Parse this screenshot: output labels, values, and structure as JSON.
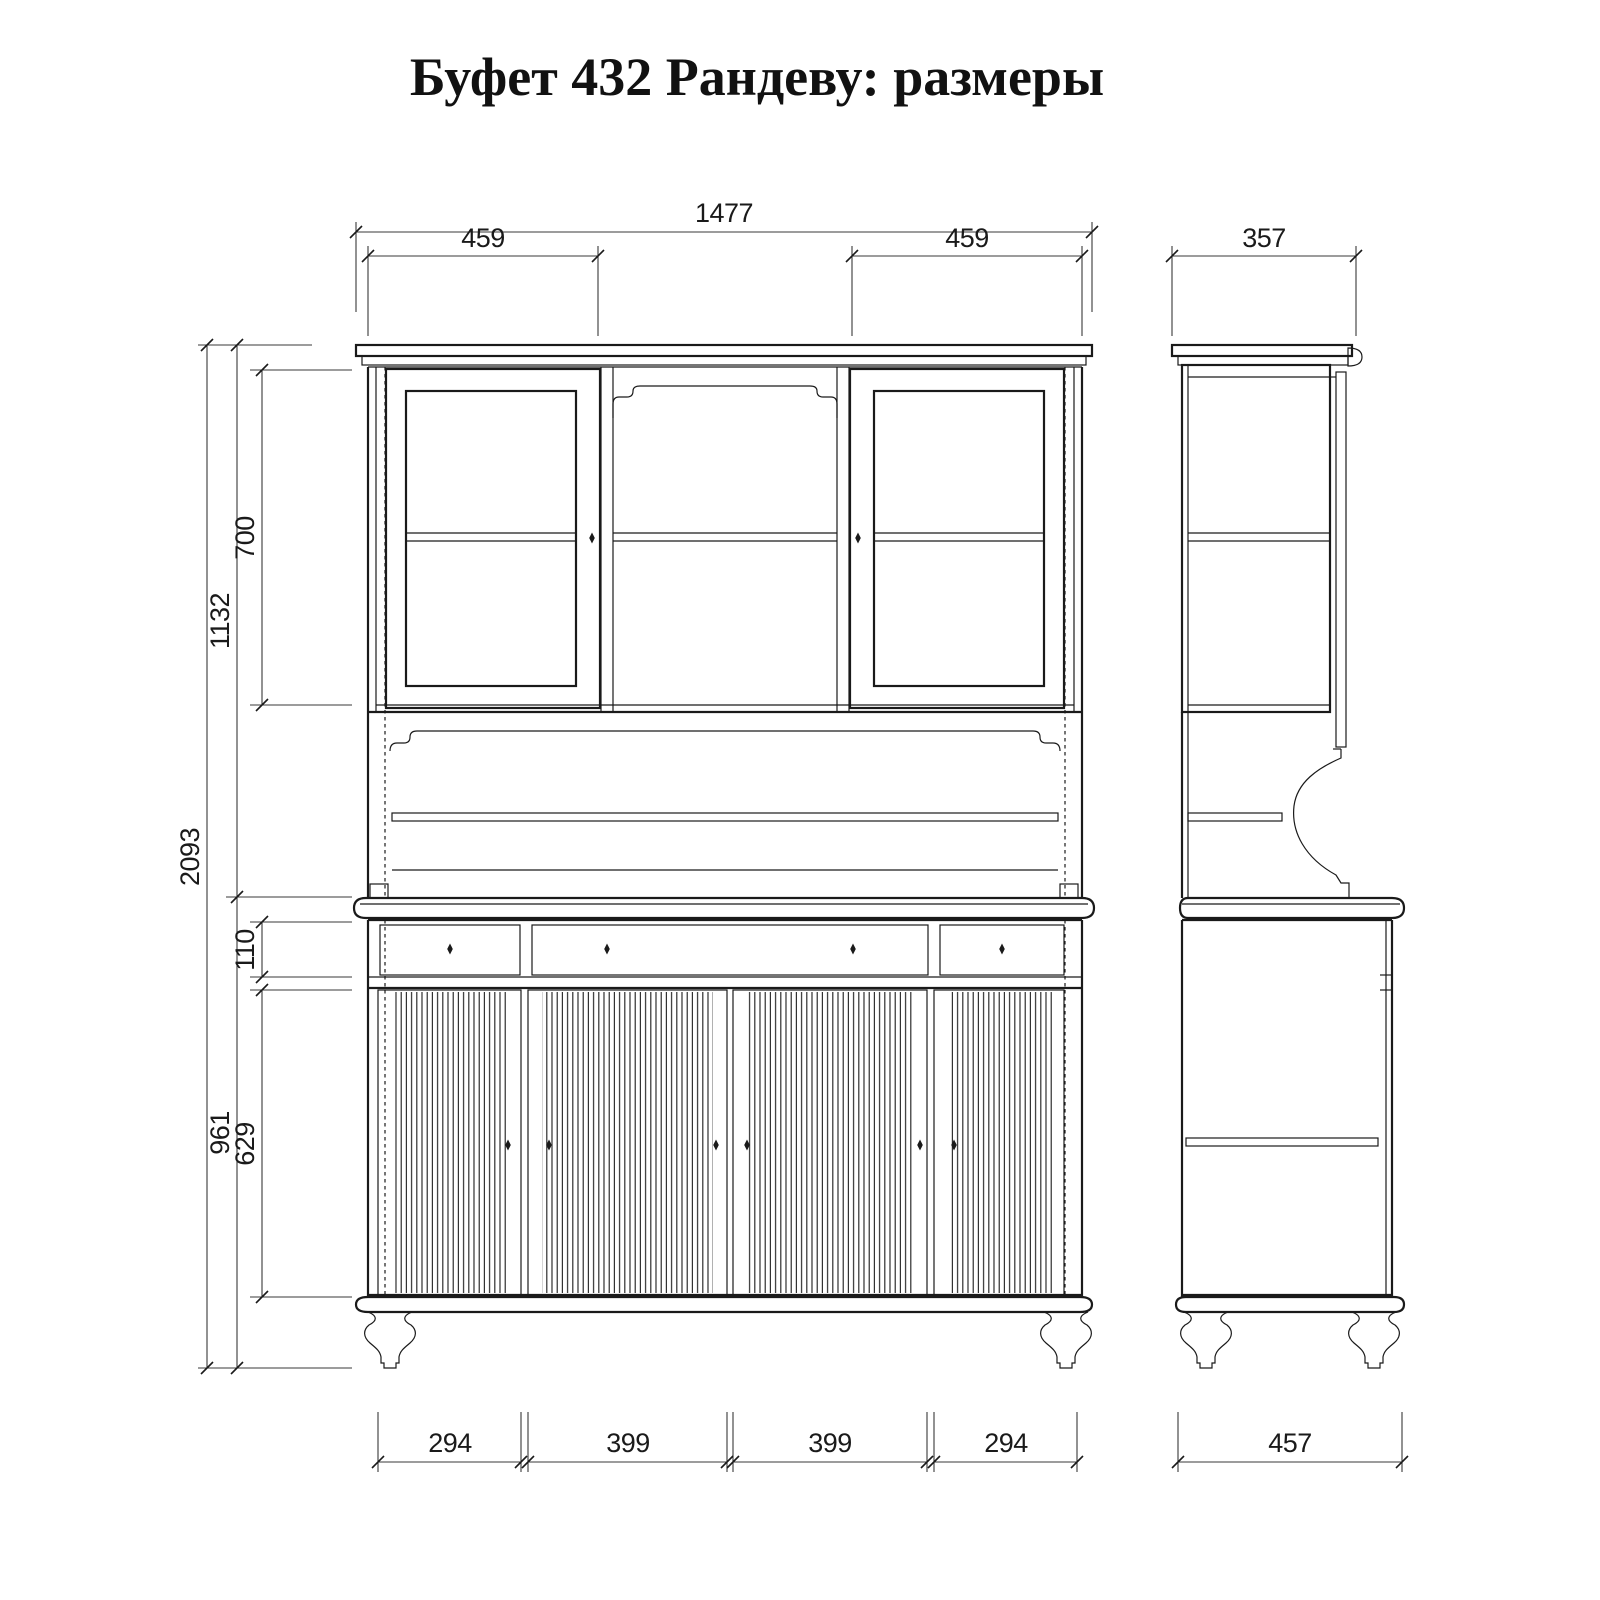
{
  "title": "Буфет 432 Рандеву: размеры",
  "colors": {
    "line": "#1a1a1a",
    "background": "#ffffff"
  },
  "front_view": {
    "label": "front-view",
    "dims": {
      "overall_width": "1477",
      "upper_left_door_width": "459",
      "upper_right_door_width": "459",
      "total_height": "2093",
      "upper_section_height": "1132",
      "glass_door_height": "700",
      "drawer_height": "110",
      "lower_section_height": "961",
      "lower_door_height": "629",
      "lower_door1_width": "294",
      "lower_door2_width": "399",
      "lower_door3_width": "399",
      "lower_door4_width": "294"
    }
  },
  "side_view": {
    "label": "side-view",
    "dims": {
      "upper_depth": "357",
      "lower_depth": "457"
    }
  }
}
